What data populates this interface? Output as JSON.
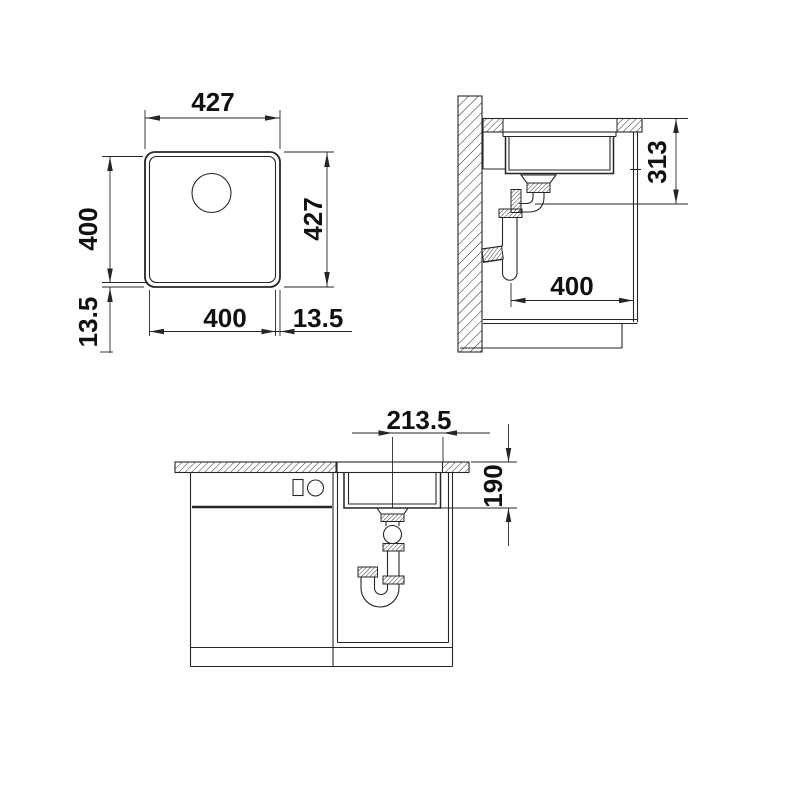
{
  "meta": {
    "background": "#ffffff",
    "line_color": "#262626",
    "text_color": "#111111",
    "drawing_type": "sink installation dimension drawing"
  },
  "views": {
    "plan": {
      "name": "top view of bowl",
      "dims": {
        "outer_width": "427",
        "outer_height": "427",
        "inner_width": "400",
        "inner_height": "400",
        "rim_left": "13.5",
        "rim_right": "13.5"
      }
    },
    "side": {
      "name": "side section with wall and trap",
      "dims": {
        "depth_with_strainer": "313",
        "min_base_depth": "400"
      }
    },
    "front": {
      "name": "front section in base cabinet",
      "dims": {
        "center_to_edge": "213.5",
        "bowl_depth": "190"
      }
    }
  }
}
